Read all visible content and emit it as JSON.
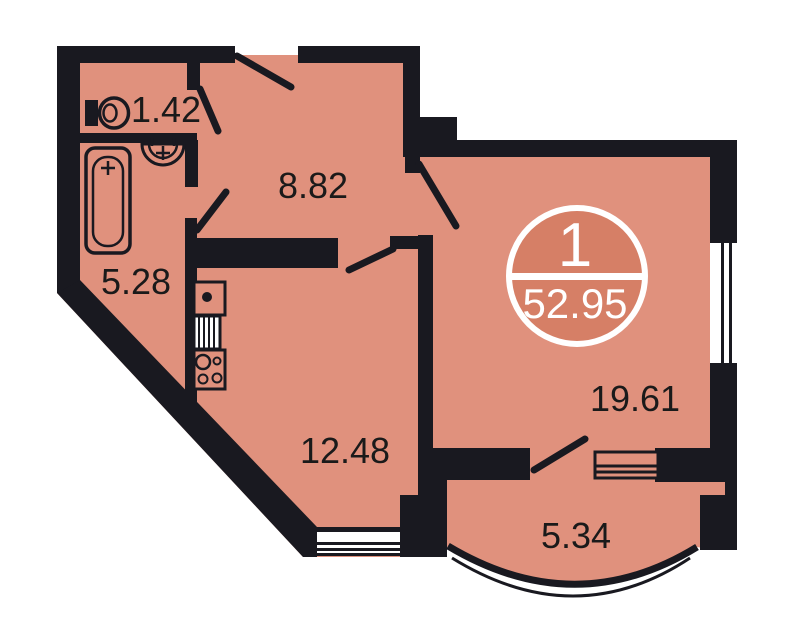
{
  "plan": {
    "badge": {
      "unit_number": "1",
      "total_area": "52.95"
    },
    "rooms": {
      "wc": {
        "area": "1.42"
      },
      "hallway": {
        "area": "8.82"
      },
      "bathroom": {
        "area": "5.28"
      },
      "kitchen_living": {
        "area": "12.48"
      },
      "living_room": {
        "area": "19.61"
      },
      "balcony": {
        "area": "5.34"
      }
    },
    "colors": {
      "floor": "#e0917d",
      "badge-fill": "#d67f66",
      "wall": "#191920",
      "outside": "#ffffff",
      "label-text": "#1a1a1a",
      "badge-text": "#ffffff"
    }
  }
}
